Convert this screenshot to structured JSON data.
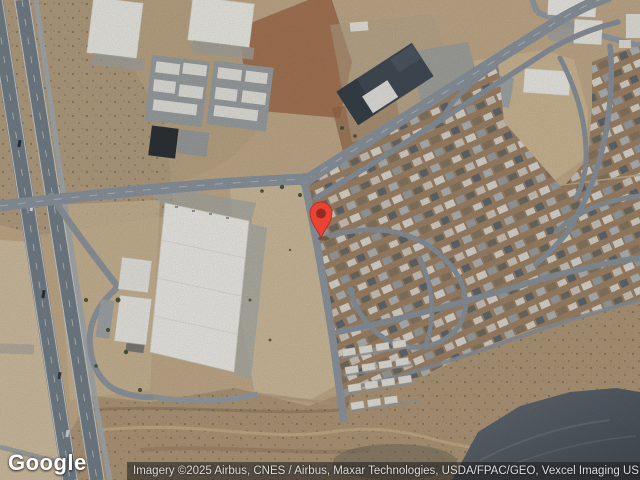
{
  "map": {
    "view_label": "Satellite map",
    "marker": {
      "x": 321,
      "y": 238,
      "pin_color": "#EA4335",
      "pin_border": "#B3271B",
      "dot_color": "#962C21"
    }
  },
  "branding": {
    "logo": "Google"
  },
  "attribution": {
    "text": "Imagery ©2025 Airbus, CNES / Airbus, Maxar Technologies, USDA/FPAC/GEO, Vexcel Imaging US, Inc."
  },
  "palette": {
    "desert": "#c7af8e",
    "desert_light": "#d6c3a2",
    "red_dirt": "#a5704e",
    "road": "#8f99a3",
    "highway": "#76828c",
    "building_white": "#f2f1ec",
    "roof_dark": "#444e58",
    "residential_ground": "#a3876a",
    "arroyo": "#b59c7c",
    "hill_shadow": "#47525c",
    "attribution_bg": "rgba(32,32,32,0.58)",
    "attribution_text": "#dedede"
  }
}
